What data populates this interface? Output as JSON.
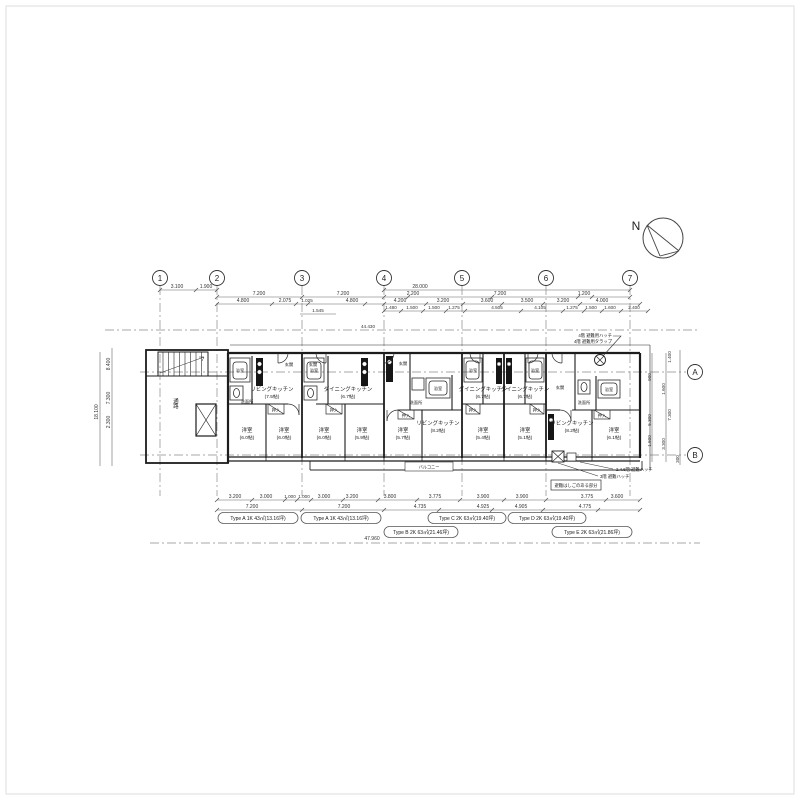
{
  "compass": {
    "north": "N"
  },
  "grid": {
    "columns": [
      "1",
      "2",
      "3",
      "4",
      "5",
      "6",
      "7"
    ],
    "rows": [
      "A",
      "B"
    ]
  },
  "dims": {
    "t1": [
      "3.100",
      "1.900",
      "28.000"
    ],
    "t2": [
      "7.200",
      "7.200",
      "2.200",
      "7.200",
      "1.200"
    ],
    "t3": [
      "4.800",
      "2.075",
      "1.025",
      "4.800",
      "4.200",
      "3.200",
      "3.600",
      "3.500",
      "3.200",
      "4.000"
    ],
    "t4": [
      "1.545",
      "1.480",
      "1.500",
      "1.500",
      "1.275",
      "4.505",
      "4.105",
      "1.275",
      "1.500",
      "1.600",
      "2.400"
    ],
    "left": [
      "8.400",
      "7.300",
      "2.300",
      "18.100"
    ],
    "right": [
      "1.400",
      "900",
      "1.600",
      "5.300",
      "7.300",
      "1.500",
      "3.300",
      "300"
    ],
    "b1": [
      "3.200",
      "3.000",
      "1.000",
      "1.000",
      "3.000",
      "3.200",
      "3.800",
      "3.775",
      "3.900",
      "3.900",
      "3.775",
      "3.600"
    ],
    "b2": [
      "7.200",
      "7.200",
      "4.735",
      "4.925",
      "4.905",
      "4.775"
    ],
    "total": "47.960",
    "level": "44.430"
  },
  "labels": {
    "corridor": "通路",
    "entrance": "玄関",
    "bath": "浴室",
    "washroom": "洗面所",
    "closet": "押入",
    "balcony": "バルコニー"
  },
  "rooms": [
    {
      "n": "リビングキッチン",
      "s": "(7.5帖)"
    },
    {
      "n": "洋室",
      "s": "(6.0帖)"
    },
    {
      "n": "洋室",
      "s": "(6.0帖)"
    },
    {
      "n": "ダイニングキッチン",
      "s": "(6.7帖)"
    },
    {
      "n": "洋室",
      "s": "(6.0帖)"
    },
    {
      "n": "洋室",
      "s": "(5.9帖)"
    },
    {
      "n": "リビングキッチン",
      "s": "(8.2帖)"
    },
    {
      "n": "洋室",
      "s": "(5.7帖)"
    },
    {
      "n": "ダイニングキッチン",
      "s": "(6.7帖)"
    },
    {
      "n": "洋室",
      "s": "(5.4帖)"
    },
    {
      "n": "ダイニングキッチン",
      "s": "(6.7帖)"
    },
    {
      "n": "洋室",
      "s": "(5.1帖)"
    },
    {
      "n": "リビングキッチン",
      "s": "(8.2帖)"
    },
    {
      "n": "洋室",
      "s": "(6.1帖)"
    }
  ],
  "types": [
    "Type A 1K 43㎡(13.16坪)",
    "Type A 1K 43㎡(13.16坪)",
    "Type C 2K 63㎡(19.40坪)",
    "Type D 2K 63㎡(19.40坪)",
    "Type B 2K 63㎡(21.46坪)",
    "Type E 2K 63㎡(21.86坪)"
  ],
  "notes": {
    "hatch_top1": "4階 避難用ハッチ",
    "hatch_top2": "4階 避難用タラップ",
    "hatch_b1": "2.4.6階 避難ハッチ",
    "hatch_b2": "3階 避難ハッチ",
    "hatch_box": "避難はしごのある部分"
  }
}
